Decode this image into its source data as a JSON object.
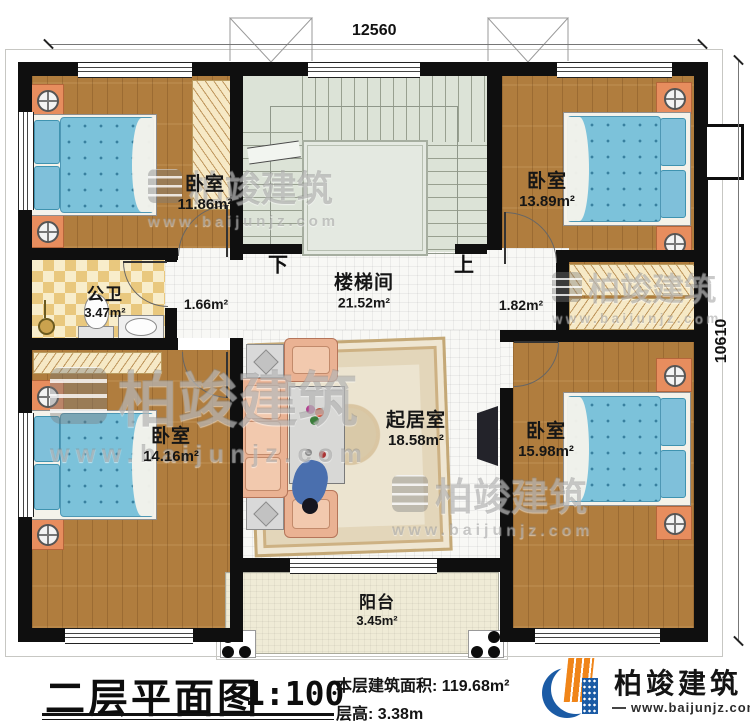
{
  "dims": {
    "top": "12560",
    "right": "10610"
  },
  "rooms": {
    "bedroom_tl": {
      "name": "卧室",
      "area": "11.86m²"
    },
    "bedroom_tr": {
      "name": "卧室",
      "area": "13.89m²"
    },
    "bedroom_bl": {
      "name": "卧室",
      "area": "14.16m²"
    },
    "bedroom_br": {
      "name": "卧室",
      "area": "15.98m²"
    },
    "bathroom": {
      "name": "公卫",
      "area": "3.47m²"
    },
    "stairwell": {
      "name": "楼梯间",
      "area": "21.52m²"
    },
    "living": {
      "name": "起居室",
      "area": "18.58m²"
    },
    "balcony": {
      "name": "阳台",
      "area": "3.45m²"
    }
  },
  "halls": {
    "left": {
      "area": "1.66m²"
    },
    "right": {
      "area": "1.82m²"
    }
  },
  "stairs": {
    "down": "下",
    "up": "上"
  },
  "title": {
    "name": "二层平面图",
    "scale": "1:100",
    "area_label": "本层建筑面积:",
    "area_value": "119.68m²",
    "height_label": "层高:",
    "height_value": "3.38m"
  },
  "brand": {
    "name": "柏竣建筑",
    "url": "www.baijunjz.com"
  },
  "colors": {
    "wall": "#0f0f0f",
    "wood_floor": "#b07d3e",
    "bed_blue": "#7cc2da",
    "stair_green": "#dce3d7",
    "bath_tile": "#e9c87e",
    "sofa_salmon": "#eab293",
    "logo_blue": "#1b5ba5",
    "logo_orange": "#f08519"
  }
}
